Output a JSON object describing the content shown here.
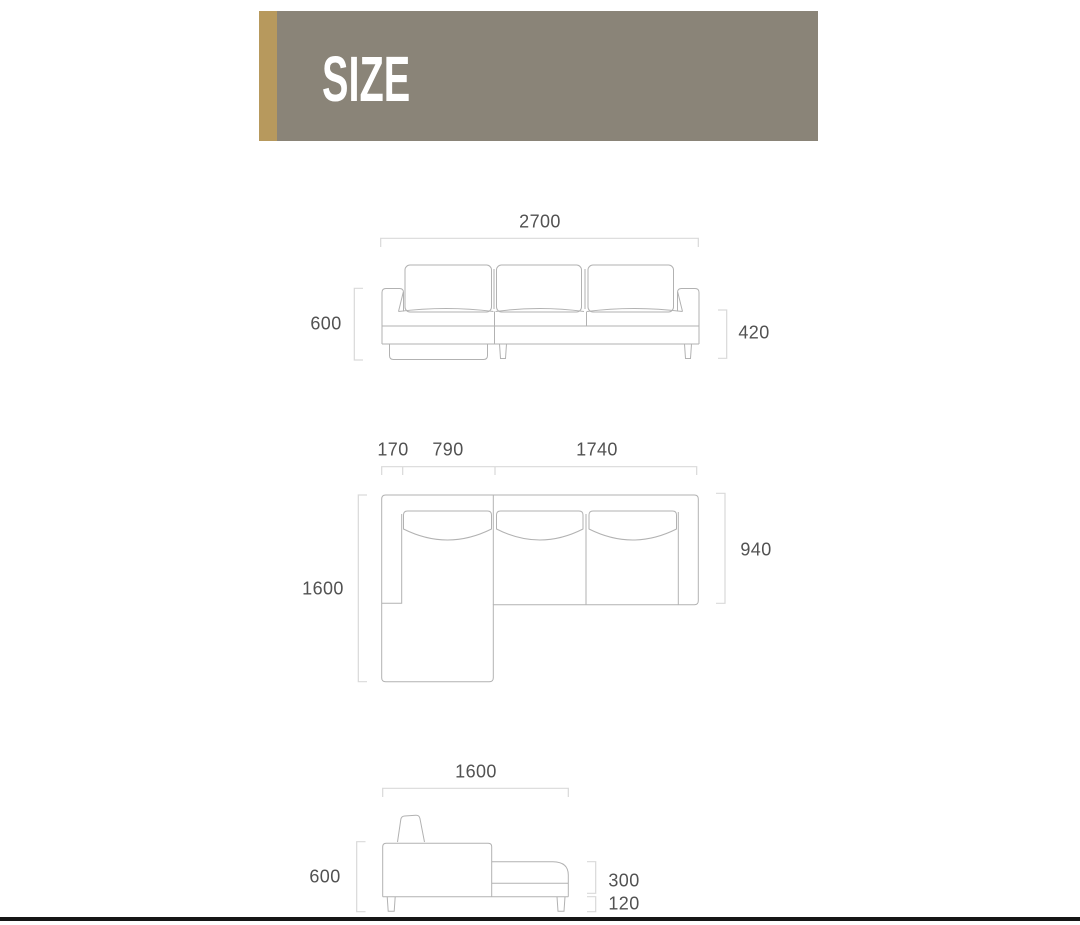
{
  "page": {
    "title": "SIZE"
  },
  "theme": {
    "accent_gold": "#b7995d",
    "banner_gray": "#8a8478",
    "line_color": "#b2b2b2",
    "bracket_color": "#d9d9d9",
    "label_color": "#525252",
    "footer_bar_color": "#161616"
  },
  "diagrams": {
    "front_view": {
      "overall_width": "2700",
      "overall_height": "600",
      "seat_height": "420"
    },
    "top_view": {
      "segments": [
        "170",
        "790",
        "1740"
      ],
      "chaise_depth": "1600",
      "body_depth": "940"
    },
    "side_view": {
      "chaise_length": "1600",
      "overall_height": "600",
      "platform_height": "300",
      "leg_height": "120"
    }
  }
}
